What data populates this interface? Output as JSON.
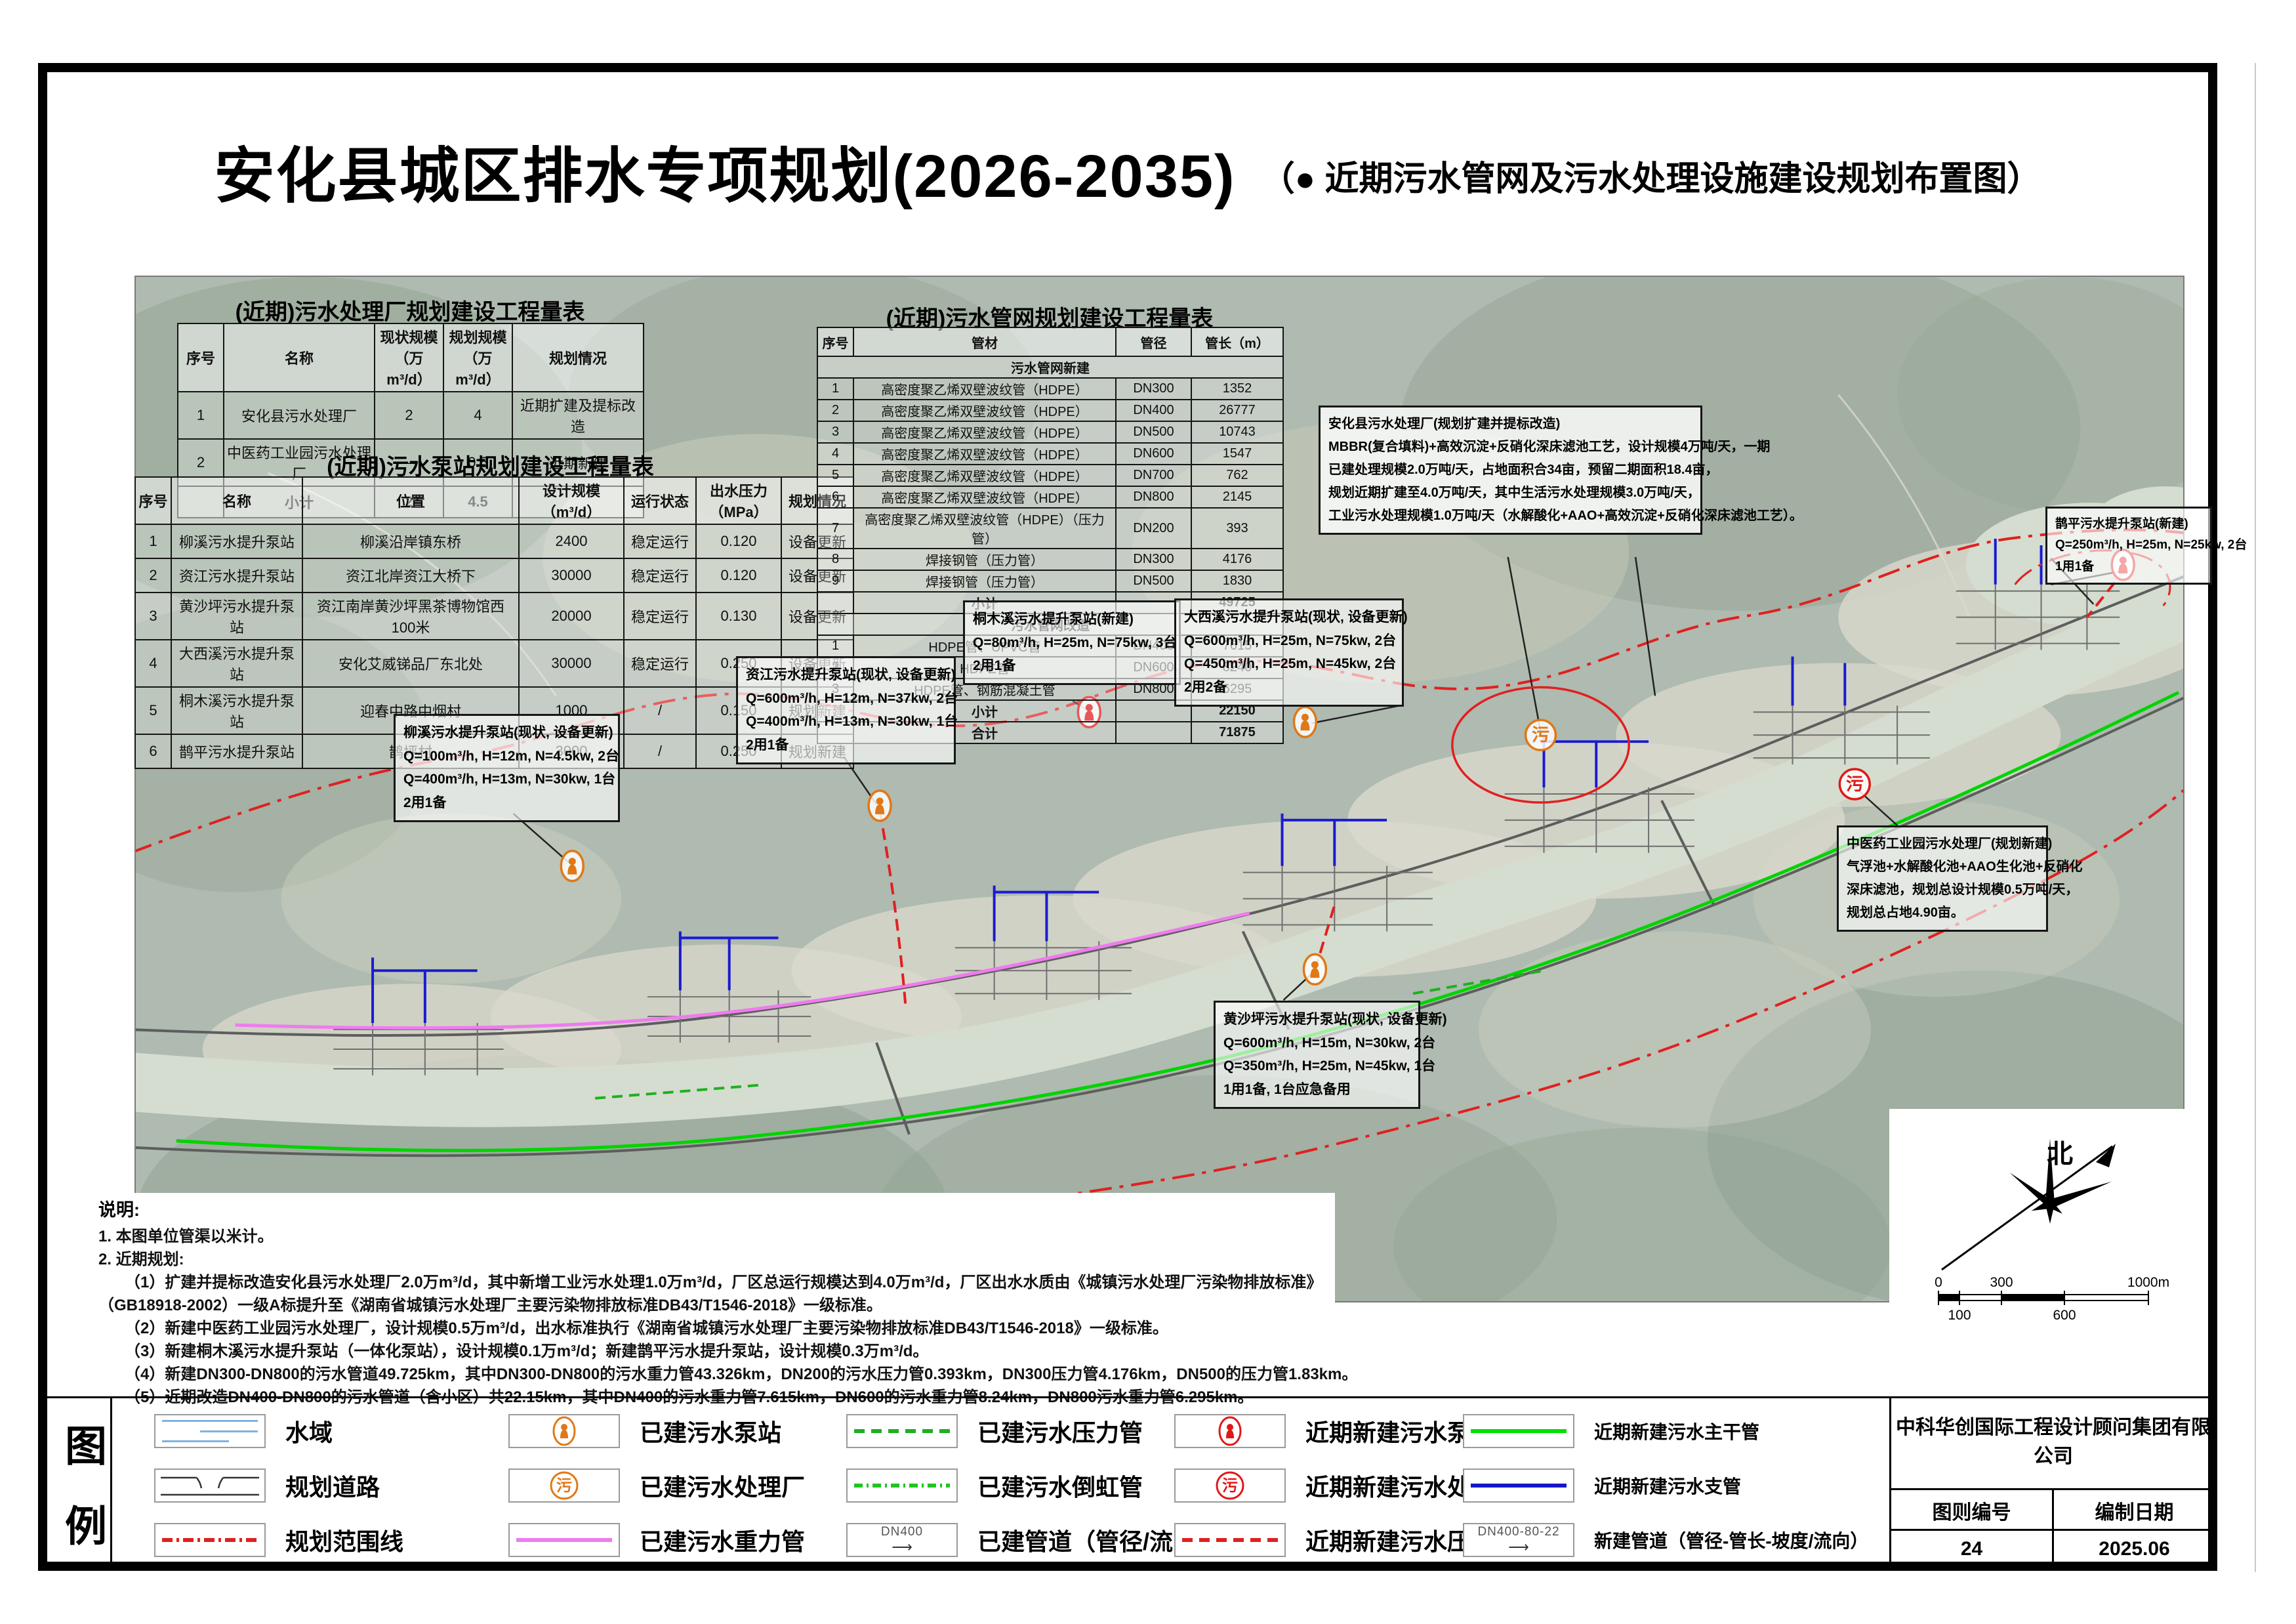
{
  "title": {
    "main": "安化县城区排水专项规划(2026-2035)",
    "sub": "（● 近期污水管网及污水处理设施建设规划布置图）"
  },
  "tables": {
    "plant": {
      "title": "(近期)污水处理厂规划建设工程量表",
      "headers": [
        "序号",
        "名称",
        "现状规模（万m³/d）",
        "规划规模（万m³/d）",
        "规划情况"
      ],
      "rows": [
        {
          "cells": [
            "1",
            "安化县污水处理厂",
            "2",
            "4",
            "近期扩建及提标改造"
          ]
        },
        {
          "cells": [
            "2",
            "中医药工业园污水处理厂",
            "—",
            "0.5",
            "近期新建"
          ]
        },
        {
          "cells": [
            "",
            "小计",
            "2",
            "4.5",
            ""
          ],
          "type": "subtotal"
        }
      ]
    },
    "pump": {
      "title": "(近期)污水泵站规划建设工程量表",
      "headers": [
        "序号",
        "名称",
        "位置",
        "设计规模（m³/d）",
        "运行状态",
        "出水压力（MPa）",
        "规划情况"
      ],
      "rows": [
        {
          "cells": [
            "1",
            "柳溪污水提升泵站",
            "柳溪沿岸镇东桥",
            "2400",
            "稳定运行",
            "0.120",
            "设备更新"
          ]
        },
        {
          "cells": [
            "2",
            "资江污水提升泵站",
            "资江北岸资江大桥下",
            "30000",
            "稳定运行",
            "0.120",
            "设备更新"
          ]
        },
        {
          "cells": [
            "3",
            "黄沙坪污水提升泵站",
            "资江南岸黄沙坪黑茶博物馆西100米",
            "20000",
            "稳定运行",
            "0.130",
            "设备更新"
          ]
        },
        {
          "cells": [
            "4",
            "大西溪污水提升泵站",
            "安化艾威锑品厂东北处",
            "30000",
            "稳定运行",
            "0.250",
            "设备更新"
          ]
        },
        {
          "cells": [
            "5",
            "桐木溪污水提升泵站",
            "迎春中路中烟村",
            "1000",
            "/",
            "0.150",
            "规划新建"
          ]
        },
        {
          "cells": [
            "6",
            "鹊平污水提升泵站",
            "鹊坪村",
            "3000",
            "/",
            "0.250",
            "规划新建"
          ]
        }
      ]
    },
    "pipe": {
      "title": "(近期)污水管网规划建设工程量表",
      "headers": [
        "序号",
        "管材",
        "管径",
        "管长（m）"
      ],
      "rows": [
        {
          "cells": [
            "",
            "污水管网新建",
            "",
            ""
          ],
          "type": "section"
        },
        {
          "cells": [
            "1",
            "高密度聚乙烯双壁波纹管（HDPE）",
            "DN300",
            "1352"
          ]
        },
        {
          "cells": [
            "2",
            "高密度聚乙烯双壁波纹管（HDPE）",
            "DN400",
            "26777"
          ]
        },
        {
          "cells": [
            "3",
            "高密度聚乙烯双壁波纹管（HDPE）",
            "DN500",
            "10743"
          ]
        },
        {
          "cells": [
            "4",
            "高密度聚乙烯双壁波纹管（HDPE）",
            "DN600",
            "1547"
          ]
        },
        {
          "cells": [
            "5",
            "高密度聚乙烯双壁波纹管（HDPE）",
            "DN700",
            "762"
          ]
        },
        {
          "cells": [
            "6",
            "高密度聚乙烯双壁波纹管（HDPE）",
            "DN800",
            "2145"
          ]
        },
        {
          "cells": [
            "7",
            "高密度聚乙烯双壁波纹管（HDPE）（压力管）",
            "DN200",
            "393"
          ]
        },
        {
          "cells": [
            "8",
            "焊接钢管（压力管）",
            "DN300",
            "4176"
          ]
        },
        {
          "cells": [
            "9",
            "焊接钢管（压力管）",
            "DN500",
            "1830"
          ]
        },
        {
          "cells": [
            "",
            "小计",
            "",
            "49725"
          ],
          "type": "subtotal"
        },
        {
          "cells": [
            "",
            "污水管网改造",
            "",
            ""
          ],
          "type": "section"
        },
        {
          "cells": [
            "1",
            "HDPE管、UPVC管",
            "DN400",
            "7615"
          ]
        },
        {
          "cells": [
            "2",
            "HDPE管",
            "DN600",
            "8240"
          ]
        },
        {
          "cells": [
            "3",
            "HDPE管、钢筋混凝土管",
            "DN800",
            "6295"
          ]
        },
        {
          "cells": [
            "",
            "小计",
            "",
            "22150"
          ],
          "type": "subtotal"
        },
        {
          "cells": [
            "",
            "合计",
            "",
            "71875"
          ],
          "type": "total"
        }
      ]
    }
  },
  "annotations": [
    {
      "title": "安化县污水处理厂(规划扩建并提标改造)",
      "lines": [
        "MBBR(复合填料)+高效沉淀+反硝化深床滤池工艺，设计规模4万吨/天，一期",
        "已建处理规模2.0万吨/天，占地面积合34亩，预留二期面积18.4亩，",
        "规划近期扩建至4.0万吨/天，其中生活污水处理规模3.0万吨/天，",
        "工业污水处理规模1.0万吨/天（水解酸化+AAO+高效沉淀+反硝化深床滤池工艺）。"
      ]
    },
    {
      "title": "鹊平污水提升泵站(新建)",
      "lines": [
        "Q=250m³/h, H=25m, N=25kw, 2台",
        "1用1备"
      ]
    },
    {
      "title": "桐木溪污水提升泵站(新建)",
      "lines": [
        "Q=80m³/h, H=25m, N=75kw, 3台",
        "2用1备"
      ]
    },
    {
      "title": "大西溪污水提升泵站(现状, 设备更新)",
      "lines": [
        "Q=600m³/h, H=25m, N=75kw, 2台",
        "Q=450m³/h, H=25m, N=45kw, 2台",
        "2用2备"
      ]
    },
    {
      "title": "资江污水提升泵站(现状, 设备更新)",
      "lines": [
        "Q=600m³/h, H=12m, N=37kw, 2台",
        "Q=400m³/h, H=13m, N=30kw, 1台",
        "2用1备"
      ]
    },
    {
      "title": "柳溪污水提升泵站(现状, 设备更新)",
      "lines": [
        "Q=100m³/h, H=12m, N=4.5kw, 2台",
        "Q=400m³/h, H=13m, N=30kw, 1台",
        "2用1备"
      ]
    },
    {
      "title": "中医药工业园污水处理厂(规划新建)",
      "lines": [
        "气浮池+水解酸化池+AAO生化池+反硝化",
        "深床滤池，规划总设计规模0.5万吨/天，",
        "规划总占地4.90亩。"
      ]
    },
    {
      "title": "黄沙坪污水提升泵站(现状, 设备更新)",
      "lines": [
        "Q=600m³/h, H=15m, N=30kw, 2台",
        "Q=350m³/h, H=25m, N=45kw, 1台",
        "1用1备, 1台应急备用"
      ]
    }
  ],
  "notes": {
    "heading": "说明:",
    "lines": [
      "1. 本图单位管渠以米计。",
      "2. 近期规划:",
      "（1）扩建并提标改造安化县污水处理厂2.0万m³/d，其中新增工业污水处理1.0万m³/d，厂区总运行规模达到4.0万m³/d，厂区出水水质由《城镇污水处理厂污染物排放标准》",
      "（GB18918-2002）一级A标提升至《湖南省城镇污水处理厂主要污染物排放标准DB43/T1546-2018》一级标准。",
      "（2）新建中医药工业园污水处理厂，设计规模0.5万m³/d，出水标准执行《湖南省城镇污水处理厂主要污染物排放标准DB43/T1546-2018》一级标准。",
      "（3）新建桐木溪污水提升泵站（一体化泵站），设计规模0.1万m³/d；新建鹊平污水提升泵站，设计规模0.3万m³/d。",
      "（4）新建DN300-DN800的污水管道49.725km，其中DN300-DN800的污水重力管43.326km，DN200的污水压力管0.393km，DN300压力管4.176km，DN500的压力管1.83km。",
      "（5）近期改造DN400-DN800的污水管道（含小区）共22.15km，其中DN400的污水重力管7.615km，DN600的污水重力管8.24km，DN800污水重力管6.295km。"
    ]
  },
  "legend": {
    "label": "图例",
    "items": [
      {
        "label": "水域",
        "type": "water"
      },
      {
        "label": "规划道路",
        "type": "road"
      },
      {
        "label": "规划范围线",
        "type": "boundary"
      },
      {
        "label": "已建污水泵站",
        "type": "pump",
        "color": "#e07818"
      },
      {
        "label": "已建污水处理厂",
        "type": "plant",
        "color": "#e07818"
      },
      {
        "label": "已建污水重力管",
        "type": "solid",
        "color": "#ee7cee"
      },
      {
        "label": "已建污水压力管",
        "type": "dash",
        "color": "#1faf1f"
      },
      {
        "label": "已建污水倒虹管",
        "type": "dashdot",
        "color": "#21c421"
      },
      {
        "label": "已建管道（管径/流向）",
        "type": "pipelabel",
        "text": "DN400"
      },
      {
        "label": "近期新建污水泵站",
        "type": "pump",
        "color": "#e01818"
      },
      {
        "label": "近期新建污水处理厂",
        "type": "plant",
        "color": "#e01818"
      },
      {
        "label": "近期新建污水压力管",
        "type": "dash",
        "color": "#e02020"
      },
      {
        "label": "近期新建污水主干管",
        "type": "solid",
        "color": "#00e000"
      },
      {
        "label": "近期新建污水支管",
        "type": "solid",
        "color": "#1616cc"
      },
      {
        "label": "新建管道（管径-管长-坡度/流向）",
        "type": "pipelabel",
        "text": "DN400-80-22"
      }
    ]
  },
  "compass": {
    "north_label": "北"
  },
  "scalebar": {
    "top": [
      "0",
      "300",
      "1000m"
    ],
    "bottom": [
      "100",
      "600"
    ]
  },
  "titleblock": {
    "company": "中科华创国际工程设计顾问集团有限公司",
    "fields": [
      {
        "label": "图则编号",
        "value": "24"
      },
      {
        "label": "编制日期",
        "value": "2025.06"
      }
    ]
  },
  "icons": {
    "plant_char": "污"
  },
  "colors": {
    "boundary_red": "#e02020",
    "main_trunk_green": "#00d400",
    "branch_blue": "#1b1bd0",
    "existing_gravity_magenta": "#ee7cee",
    "existing_pump_orange": "#e07818",
    "new_pump_red": "#e01818",
    "water": "#d4ddcf",
    "terrain": "#afbab0"
  }
}
